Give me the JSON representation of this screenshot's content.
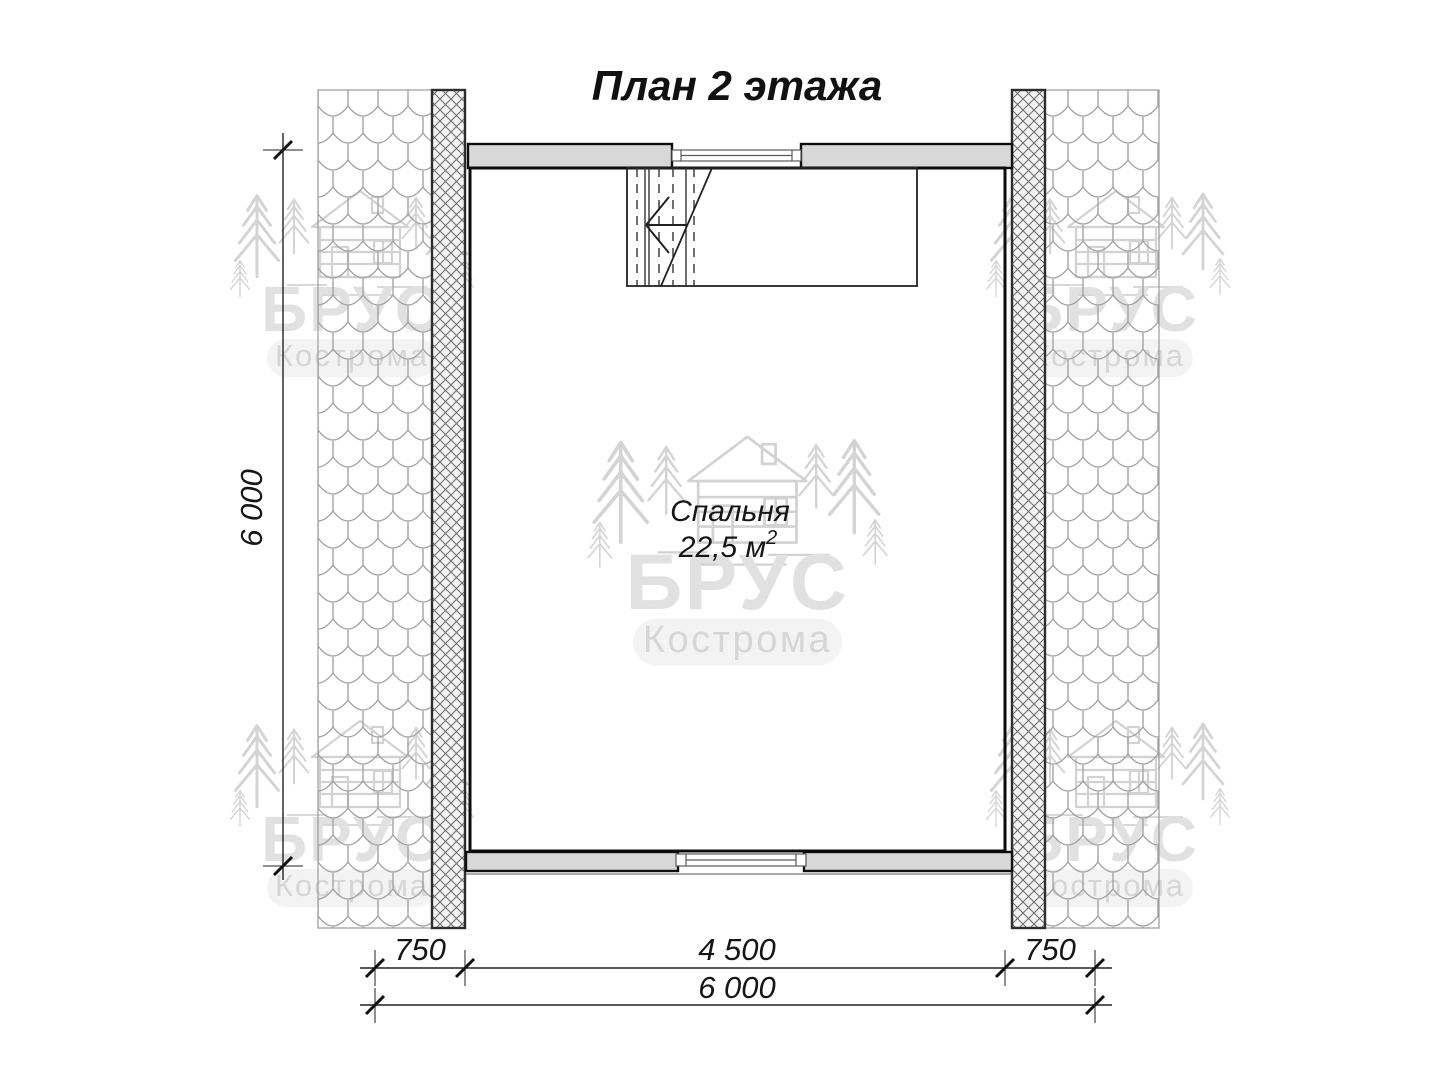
{
  "title": "План 2 этажа",
  "room": {
    "name": "Спальня",
    "area": "22,5 м",
    "area_superscript": "2"
  },
  "dimensions": {
    "left_total": "6 000",
    "bottom_segments": [
      "750",
      "4 500",
      "750"
    ],
    "bottom_total": "6 000"
  },
  "watermark": {
    "brand": "БРУС",
    "city": "Кострома"
  },
  "colors": {
    "wall_fill": "#d8d8d8",
    "line": "#1a1a1a",
    "hatch_line": "#6f6f6f",
    "tile_line": "#a3a3a3",
    "watermark_gray": "#dedede"
  }
}
